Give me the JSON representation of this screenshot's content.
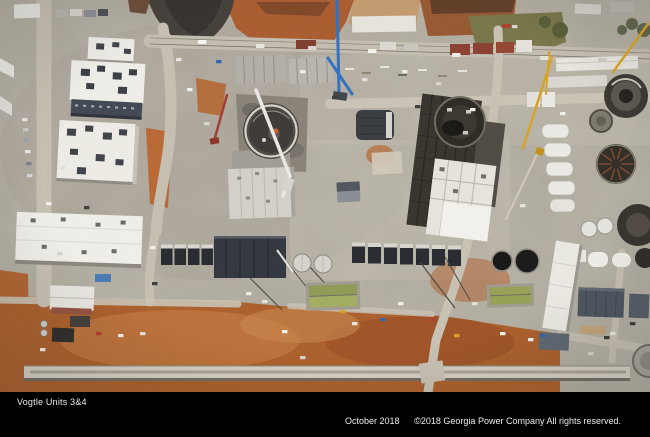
{
  "caption": {
    "title": "Vogtle Units 3&4",
    "date": "October 2018",
    "copyright": "©2018 Georgia Power Company All rights reserved."
  },
  "colors": {
    "caption-bg": "#000000",
    "caption-text": "#ededed",
    "concrete": "#b2ac9f",
    "dirt-orange": "#ab5d28",
    "roof-white": "#f0eee8",
    "steel-dark": "#2f333a",
    "basin-green": "#96a050",
    "crane-yellow": "#d7a21f",
    "crane-blue": "#2e6fc0",
    "crane-red": "#a33a2c"
  }
}
